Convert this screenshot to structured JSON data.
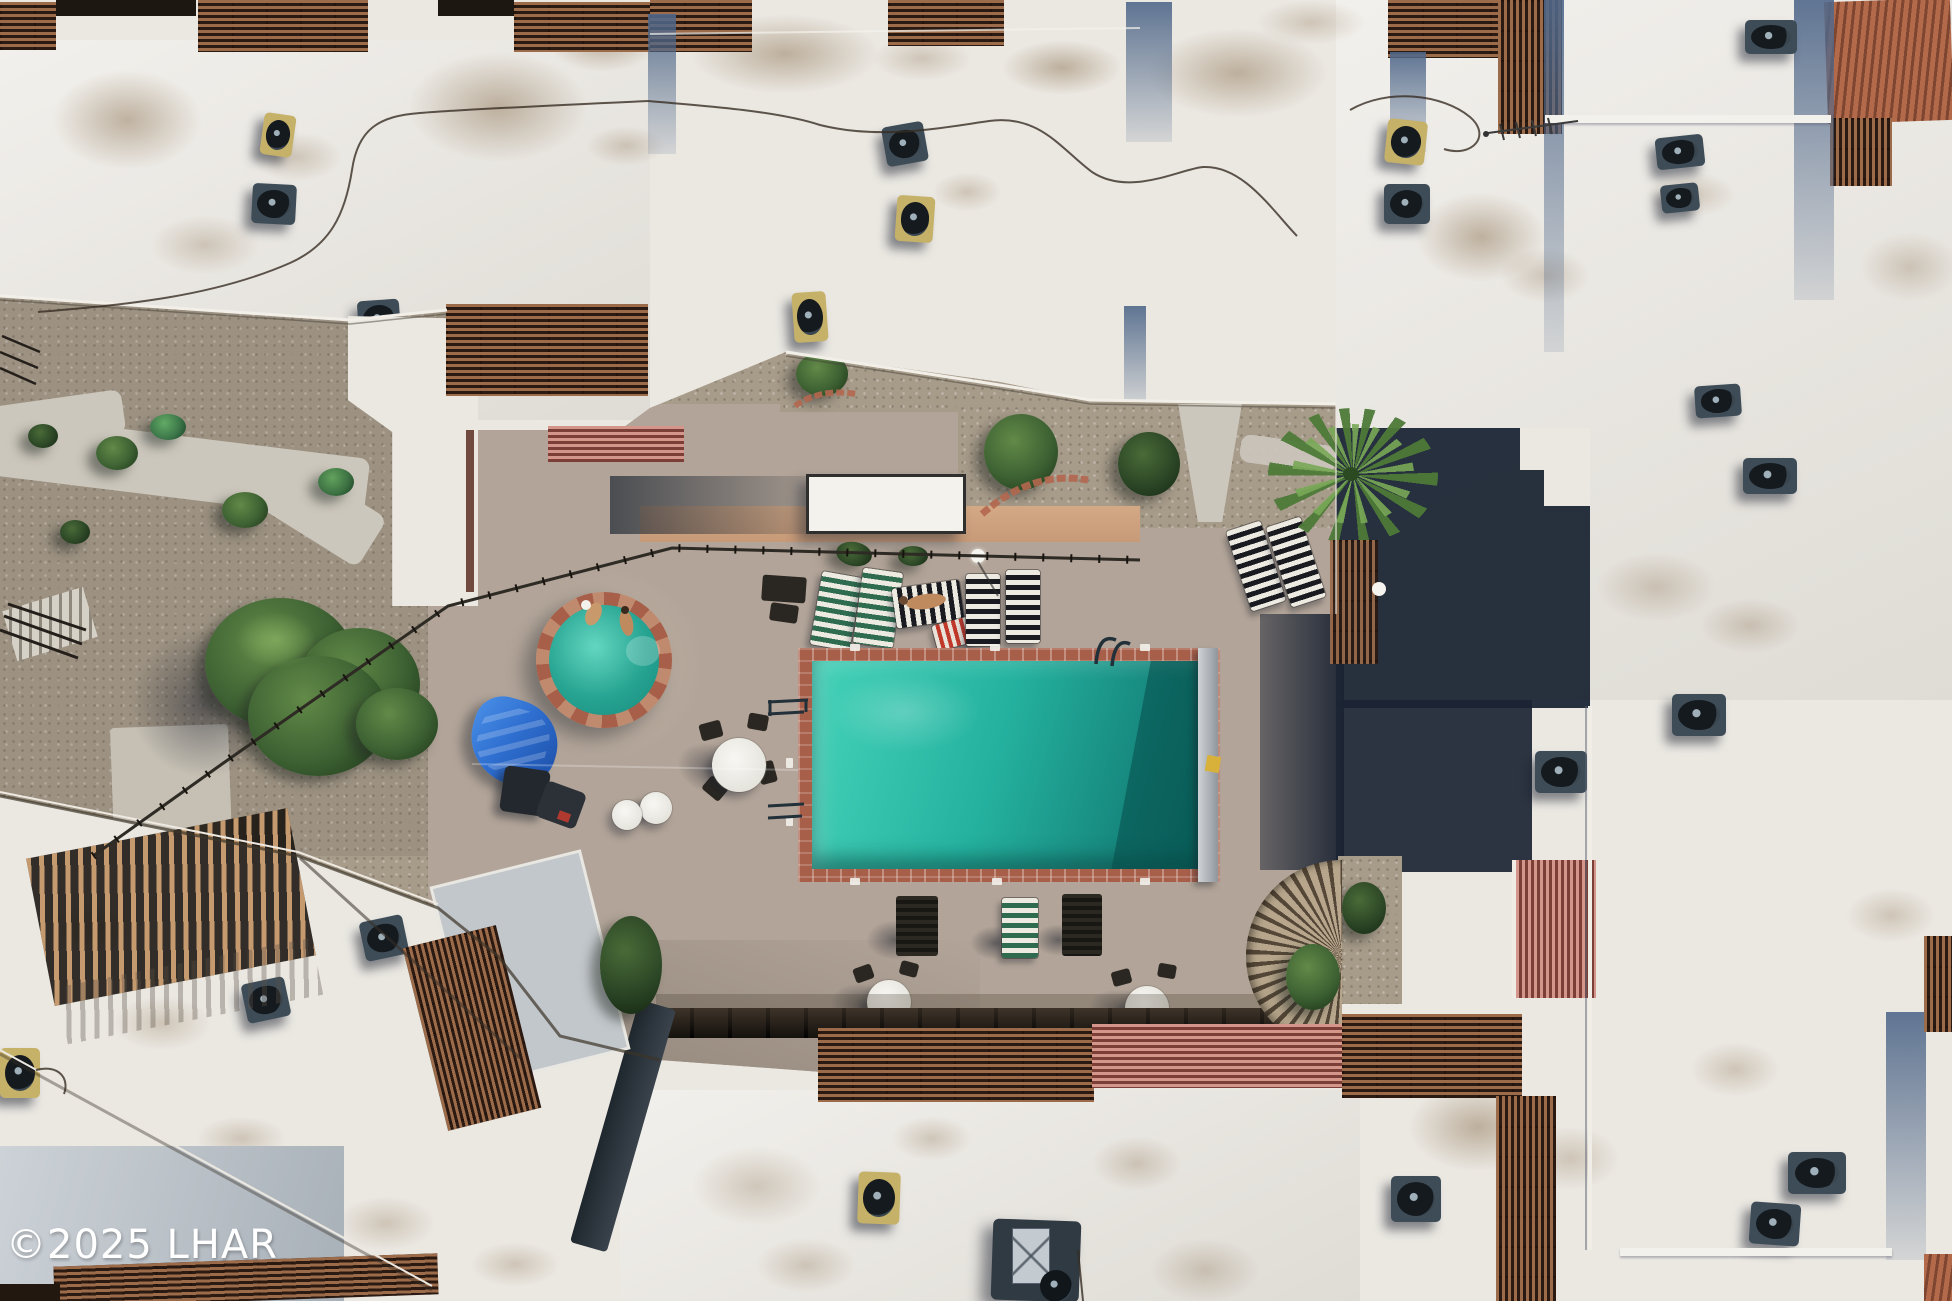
{
  "meta": {
    "description": "Aerial drone photograph of a condominium complex: white flat rooftops with wood pergolas and AC units surrounding a central courtyard with a rectangular swimming pool, round spa, striped sun loungers, umbrella tables and desert landscaping."
  },
  "watermark": {
    "text": "©2025 LHAR",
    "color": "#ffffff"
  },
  "palette": {
    "roof": "#ebe8e2",
    "shade_blue": "#5d7a94",
    "shadow_dark": "#1b2433",
    "gravel": "#a79b8a",
    "concrete": "#ccc7bc",
    "deck": "#b2a498",
    "pool_light": "#45d2b9",
    "pool_mid": "#25b3a0",
    "pool_dark": "#0d6e67",
    "spa_water": "#2aa893",
    "brick": "#a85f4a",
    "brick_light": "#c08a6e",
    "wood": "#9c6b4a",
    "wood_gap": "#2a1a12",
    "wood_light": "#c59a6f",
    "pink_slat": "#d4958a",
    "pink_gap": "#7c3f37",
    "stripe_green": "#2e6b4f",
    "stripe_dark": "#191b20",
    "stripe_white": "#eceae1",
    "tarp": "#2f6fd0",
    "ac_dark": "#3d4c57",
    "ac_gold": "#c6b169",
    "peach": "#d4a985",
    "watermark_color": "#ffffff"
  },
  "scene": {
    "pool": {
      "label": "main swimming pool",
      "coping": "red brick",
      "cover_roller": "right edge"
    },
    "spa": {
      "label": "round hot tub",
      "occupants": 2
    },
    "furniture": {
      "striped_loungers": 9,
      "umbrella_tables": 4,
      "stripe_styles": [
        "green-white",
        "black-white",
        "red-white"
      ]
    },
    "rooftops": {
      "surface": "white membrane",
      "ac_units": 23,
      "pergolas": "wood and salmon slats"
    },
    "landscaping": [
      "gravel beds",
      "desert bushes",
      "palm tree",
      "shade tree",
      "brick edging"
    ]
  }
}
